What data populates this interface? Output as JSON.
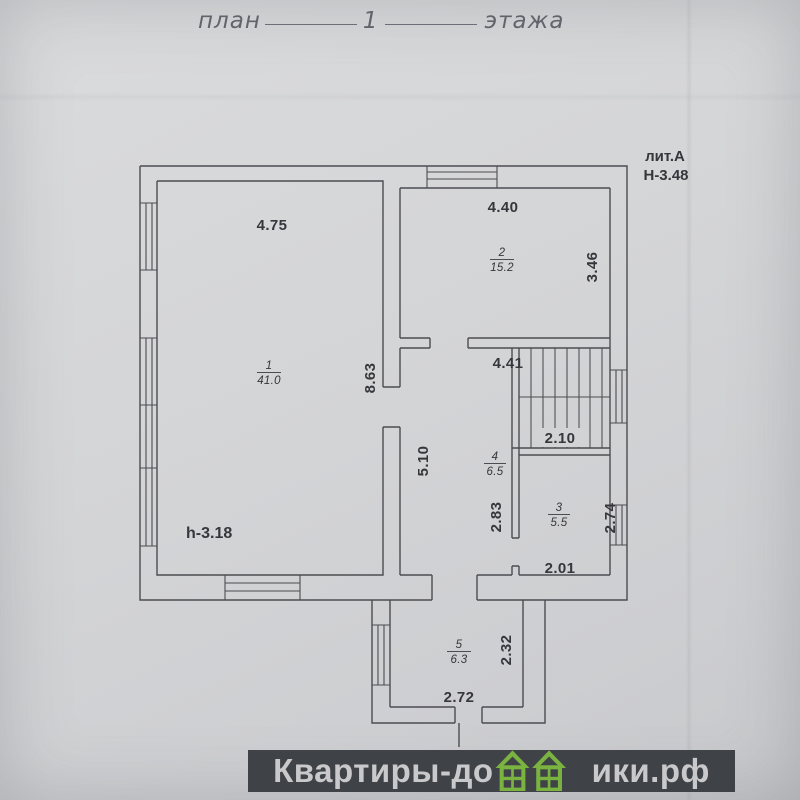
{
  "page_title": {
    "prefix": "план",
    "floor_number": "1",
    "suffix": "этажа"
  },
  "plan_annotations": {
    "liter": "лит.А",
    "building_height": "Н-3.48",
    "ceiling_height": "h-3.18"
  },
  "rooms": [
    {
      "number": "1",
      "area": "41.0"
    },
    {
      "number": "2",
      "area": "15.2"
    },
    {
      "number": "3",
      "area": "5.5"
    },
    {
      "number": "4",
      "area": "6.5"
    },
    {
      "number": "5",
      "area": "6.3"
    }
  ],
  "dimensions": {
    "room1_width": "4.75",
    "room1_depth": "8.63",
    "room2_width": "4.40",
    "room2_depth": "3.46",
    "hall_width": "4.41",
    "hall_depth": "5.10",
    "stair_width": "2.10",
    "room3_depth_left": "2.83",
    "room3_depth_right": "2.74",
    "room3_width": "2.01",
    "porch_depth": "2.32",
    "porch_width": "2.72"
  },
  "watermark": {
    "text_before": "Квартиры-до",
    "text_after": "ики.рф",
    "site_name": "Квартиры-домики.рф"
  },
  "colors": {
    "paper": "#d4d5d7",
    "ink": "#4c4c52",
    "watermark_bar": "#3f4347",
    "watermark_text": "#c9c9cb",
    "house_green": "#7ab340"
  }
}
